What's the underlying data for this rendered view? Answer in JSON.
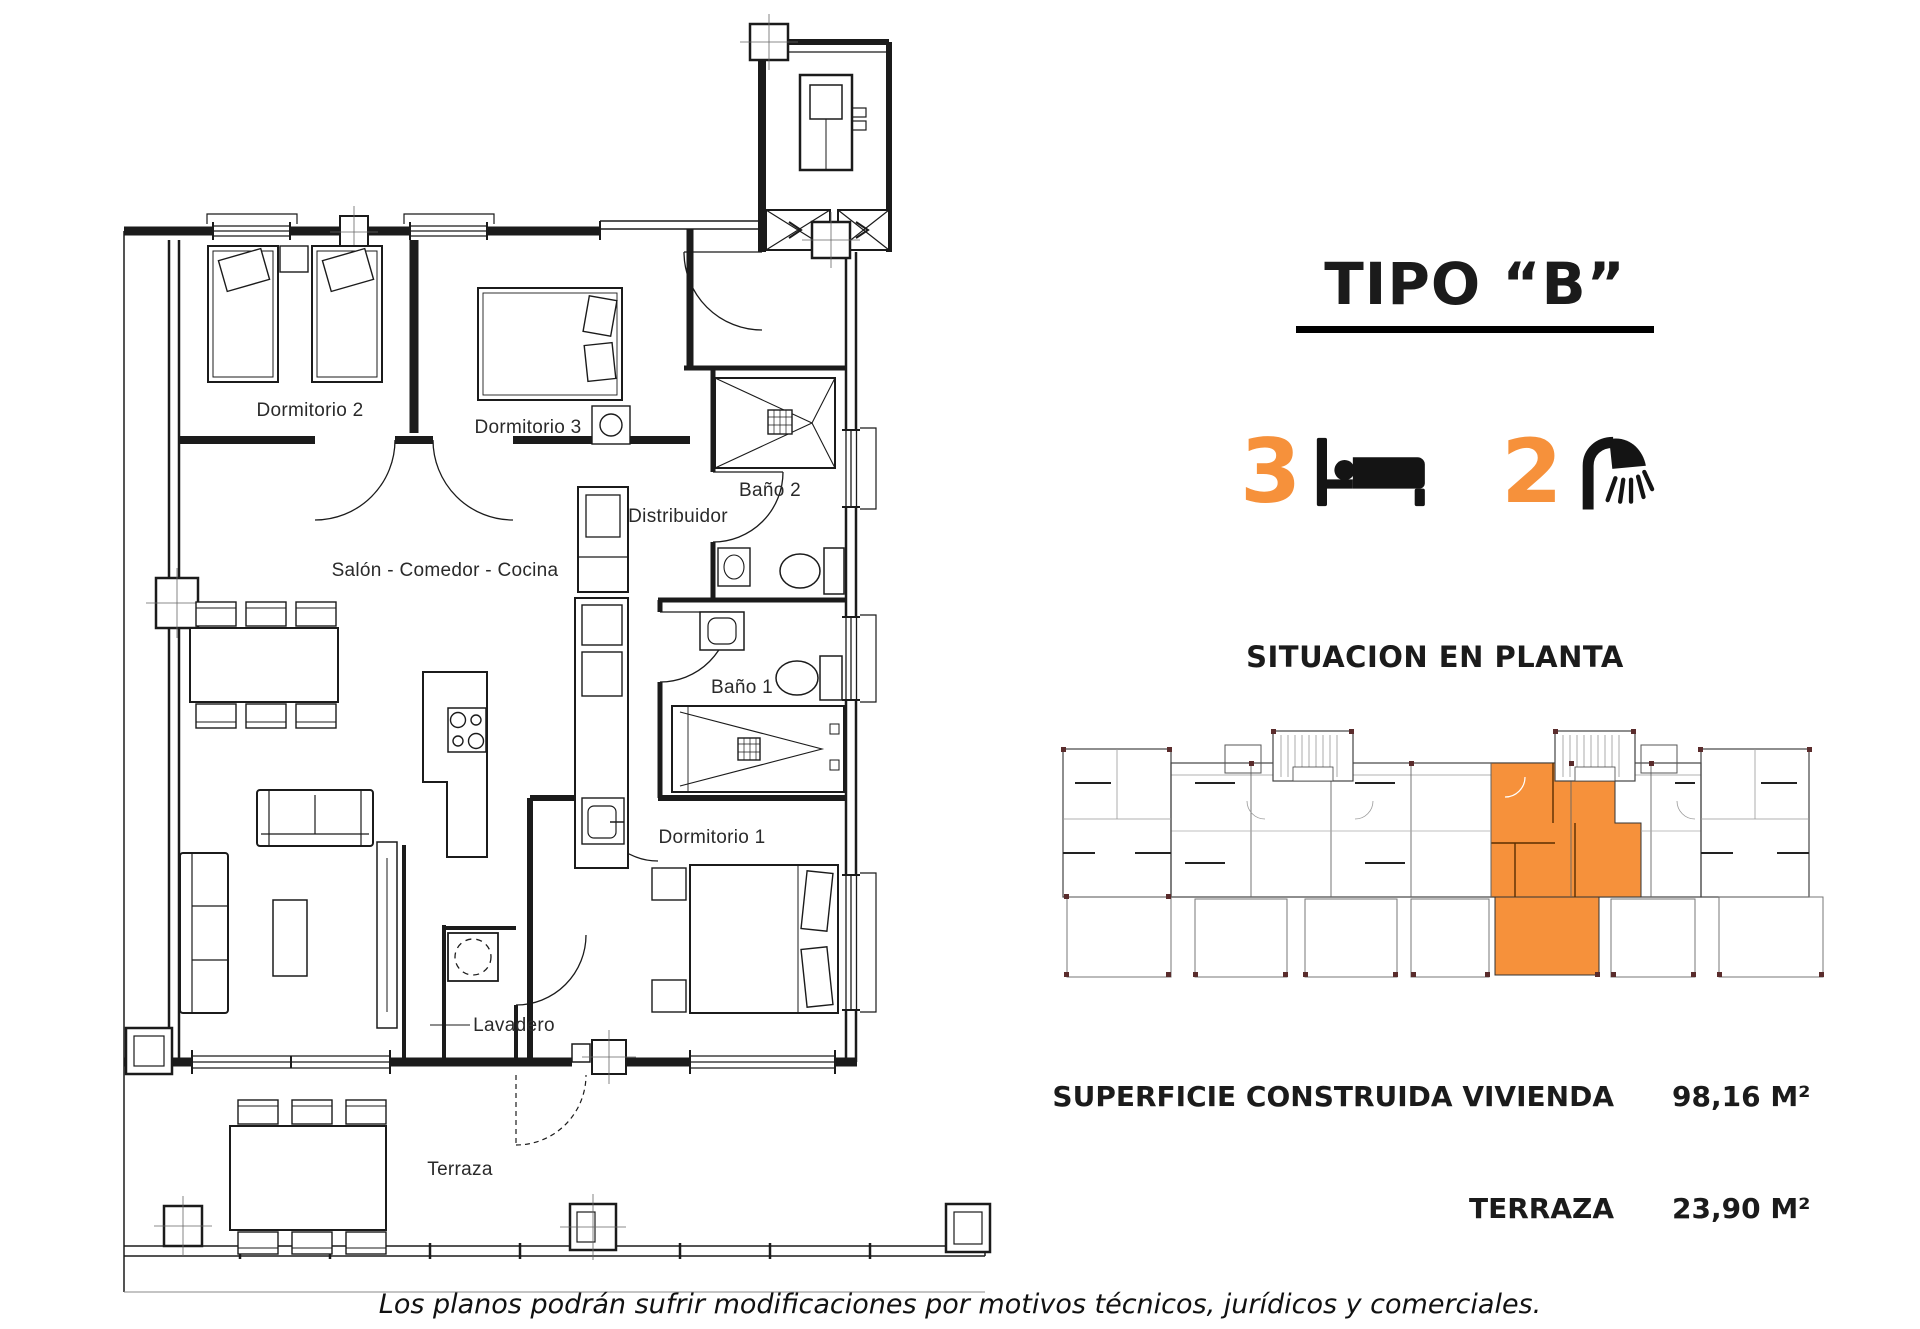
{
  "colors": {
    "accent_orange": "#F6913B",
    "line_dark": "#1b1b1b"
  },
  "floor_plan": {
    "rooms": [
      {
        "id": "dormitorio-2",
        "label": "Dormitorio 2"
      },
      {
        "id": "dormitorio-3",
        "label": "Dormitorio 3"
      },
      {
        "id": "bano-2",
        "label": "Baño 2"
      },
      {
        "id": "distribuidor",
        "label": "Distribuidor"
      },
      {
        "id": "salon-comedor-cocina",
        "label": "Salón - Comedor - Cocina"
      },
      {
        "id": "bano-1",
        "label": "Baño 1"
      },
      {
        "id": "dormitorio-1",
        "label": "Dormitorio 1"
      },
      {
        "id": "lavadero",
        "label": "Lavadero"
      },
      {
        "id": "terraza",
        "label": "Terraza"
      }
    ]
  },
  "panel": {
    "title": "TIPO “B”",
    "bedrooms": {
      "count": "3",
      "icon": "bed-icon"
    },
    "bathrooms": {
      "count": "2",
      "icon": "shower-icon"
    },
    "situation_heading": "SITUACION EN PLANTA",
    "areas": [
      {
        "label": "SUPERFICIE CONSTRUIDA VIVIENDA",
        "value": "98,16 M²"
      },
      {
        "label": "TERRAZA",
        "value": "23,90 M²"
      }
    ]
  },
  "footer": {
    "disclaimer": "Los planos podrán sufrir modificaciones por motivos técnicos, jurídicos y comerciales."
  }
}
